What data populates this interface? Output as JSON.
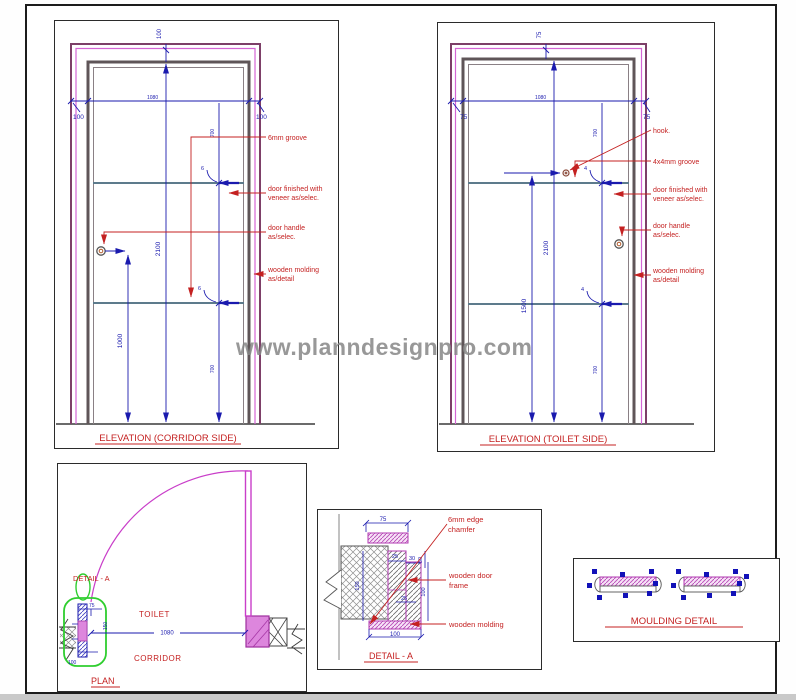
{
  "watermark": "www.planndesignpro.com",
  "colors": {
    "dimension_blue": "#1a1aae",
    "annotation_red": "#c42121",
    "architrave_purple": "#7d3f68",
    "magenta": "#c93ec9",
    "frame_gray": "#5f5558",
    "groove_gray": "#5d7b8c",
    "highlight_green": "#2fce2f",
    "watermark_gray": "#878787"
  },
  "elevation_corridor": {
    "title": "ELEVATION (CORRIDOR SIDE)",
    "dim_top": "100",
    "dim_left": "100",
    "dim_right": "100",
    "dim_width": "1080",
    "dim_height": "2100",
    "dim_handle": "1000",
    "dim_panel_a": "700",
    "dim_panel_b": "700",
    "dim_groove": "6",
    "ann_groove": "6mm groove",
    "ann_finish_1": "door finished with",
    "ann_finish_2": "veneer as/selec.",
    "ann_handle_1": "door handle",
    "ann_handle_2": "as/selec.",
    "ann_molding_1": "wooden molding",
    "ann_molding_2": "as/detail"
  },
  "elevation_toilet": {
    "title": "ELEVATION (TOILET SIDE)",
    "dim_top": "75",
    "dim_left": "75",
    "dim_right": "75",
    "dim_width": "1080",
    "dim_height": "2100",
    "dim_hook": "1500",
    "dim_panel_a": "700",
    "dim_panel_b": "700",
    "dim_groove": "4",
    "ann_hook": "hook.",
    "ann_groove": "4x4mm groove",
    "ann_finish_1": "door finished with",
    "ann_finish_2": "veneer as/selec.",
    "ann_handle_1": "door handle",
    "ann_handle_2": "as/selec.",
    "ann_molding_1": "wooden molding",
    "ann_molding_2": "as/detail"
  },
  "plan": {
    "title": "PLAN",
    "label_detail": "DETAIL - A",
    "label_toilet": "TOILET",
    "label_corridor": "CORRIDOR",
    "dim_opening": "1080",
    "dim_frame": "75",
    "dim_depth": "150",
    "dim_molding": "100"
  },
  "detail_a": {
    "title": "DETAIL - A",
    "ann_chamfer_1": "6mm edge",
    "ann_chamfer_2": "chamfer",
    "ann_frame_1": "wooden door",
    "ann_frame_2": "frame",
    "ann_molding": "wooden molding",
    "dim_top": "75",
    "dim_a": "25",
    "dim_b": "30",
    "dim_c": "50",
    "dim_d": "150",
    "dim_e": "25",
    "dim_f": "100",
    "dim_g": "100"
  },
  "moulding": {
    "title": "MOULDING DETAIL"
  }
}
